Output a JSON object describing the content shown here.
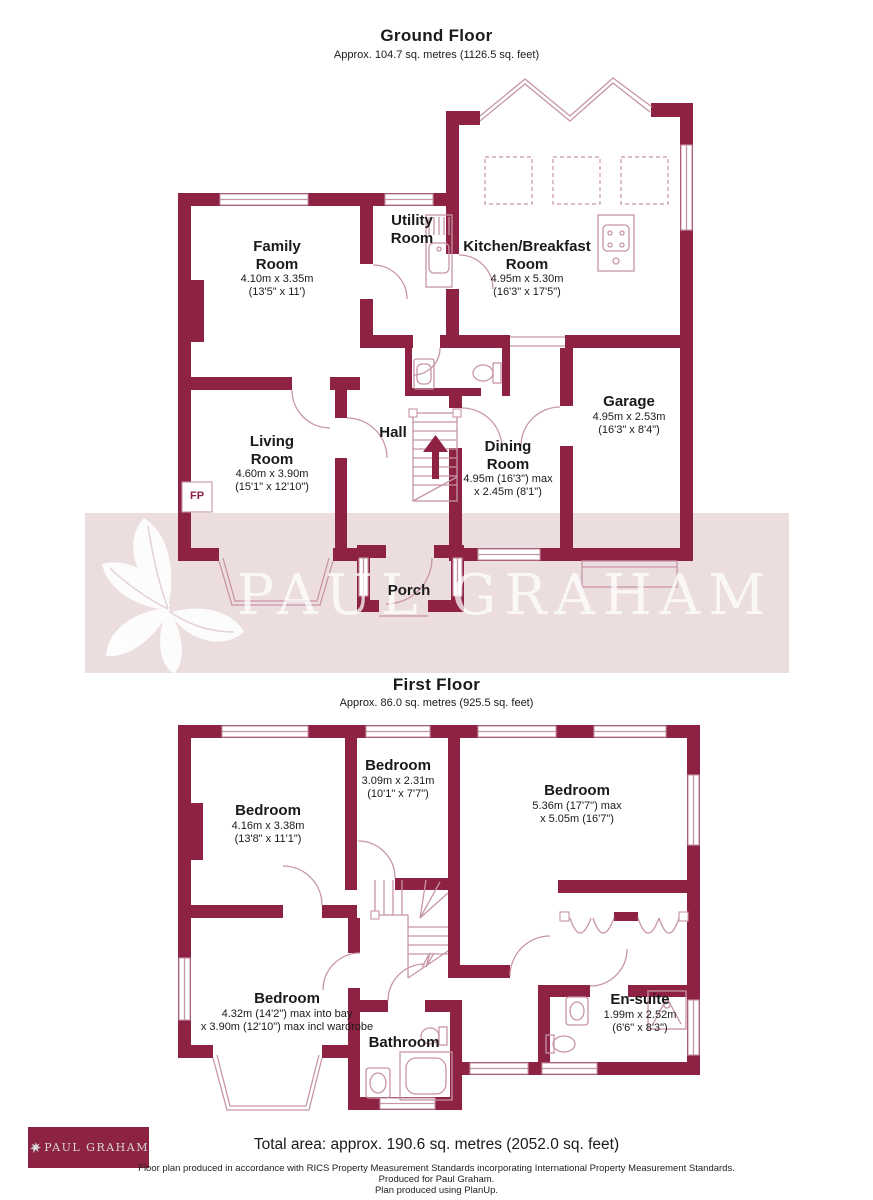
{
  "colors": {
    "wall": "#8d2242",
    "fixture_outline": "#c795a8",
    "watermark_band": "#ecdede",
    "logo_background": "#8d2342",
    "logo_text": "#d6d6d6"
  },
  "ground_floor": {
    "title": "Ground Floor",
    "subtitle": "Approx. 104.7 sq. metres (1126.5 sq. feet)",
    "rooms": {
      "family": {
        "name1": "Family",
        "name2": "Room",
        "dim1": "4.10m x 3.35m",
        "dim2": "(13'5\" x 11')"
      },
      "utility": {
        "name1": "Utility",
        "name2": "Room"
      },
      "kitchen": {
        "name1": "Kitchen/Breakfast",
        "name2": "Room",
        "dim1": "4.95m x 5.30m",
        "dim2": "(16'3\" x 17'5\")"
      },
      "living": {
        "name1": "Living",
        "name2": "Room",
        "dim1": "4.60m x 3.90m",
        "dim2": "(15'1\" x 12'10\")"
      },
      "hall": {
        "name1": "Hall"
      },
      "dining": {
        "name1": "Dining",
        "name2": "Room",
        "dim1": "4.95m (16'3\") max",
        "dim2": "x 2.45m (8'1\")"
      },
      "garage": {
        "name1": "Garage",
        "dim1": "4.95m x 2.53m",
        "dim2": "(16'3\" x 8'4\")"
      },
      "porch": {
        "name1": "Porch"
      },
      "fireplace_label": "FP"
    }
  },
  "first_floor": {
    "title": "First Floor",
    "subtitle": "Approx. 86.0 sq. metres (925.5 sq. feet)",
    "rooms": {
      "bedroom1": {
        "name1": "Bedroom",
        "dim1": "4.16m x 3.38m",
        "dim2": "(13'8\" x 11'1\")"
      },
      "bedroom2": {
        "name1": "Bedroom",
        "dim1": "3.09m x 2.31m",
        "dim2": "(10'1\" x 7'7\")"
      },
      "bedroom3": {
        "name1": "Bedroom",
        "dim1": "5.36m (17'7\") max",
        "dim2": "x 5.05m (16'7\")"
      },
      "bedroom4": {
        "name1": "Bedroom",
        "dim1": "4.32m (14'2\") max into bay",
        "dim2": "x 3.90m (12'10\") max incl wardrobe"
      },
      "bathroom": {
        "name1": "Bathroom"
      },
      "ensuite": {
        "name1": "En-suite",
        "dim1": "1.99m x 2.52m",
        "dim2": "(6'6\" x 8'3\")"
      }
    }
  },
  "watermark": {
    "text": "PAUL GRAHAM"
  },
  "logo": {
    "text": "PAUL GRAHAM"
  },
  "footer": {
    "total": "Total area: approx. 190.6 sq. metres (2052.0 sq. feet)",
    "line1": "Floor plan produced in accordance with RICS Property Measurement Standards incorporating International Property Measurement Standards.",
    "line2": "Produced for Paul Graham.",
    "line3": "Plan produced using PlanUp."
  }
}
